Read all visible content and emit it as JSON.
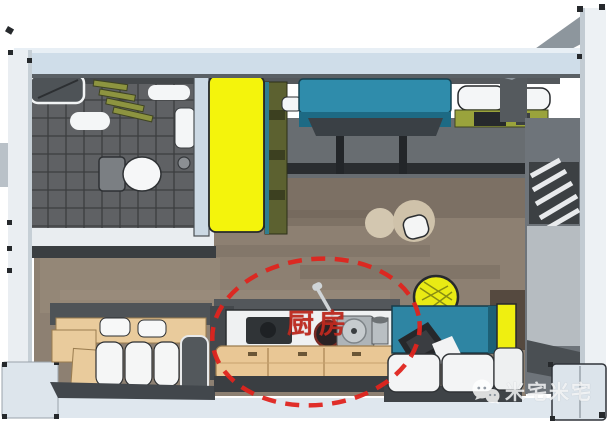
{
  "annotation": {
    "label": "厨房",
    "label_color": "#be2a20",
    "ellipse_color": "#df241d"
  },
  "watermark": {
    "icon": "wechat-icon",
    "text": "米宅米宅",
    "text_color": "rgba(255,255,255,0.78)"
  },
  "palette": {
    "top_wall_blue": "#cfdde9",
    "wall_white": "#eaeef2",
    "wood_floor": "#8d8072",
    "bathroom_tile": "#5f6164",
    "wardrobe_yellow": "#f4f40c",
    "loft_bed_teal": "#2f8cab",
    "kitchen_cabinet_tan": "#e9c795",
    "table_teal": "#2e85a3",
    "highlight_red": "#df241d"
  }
}
